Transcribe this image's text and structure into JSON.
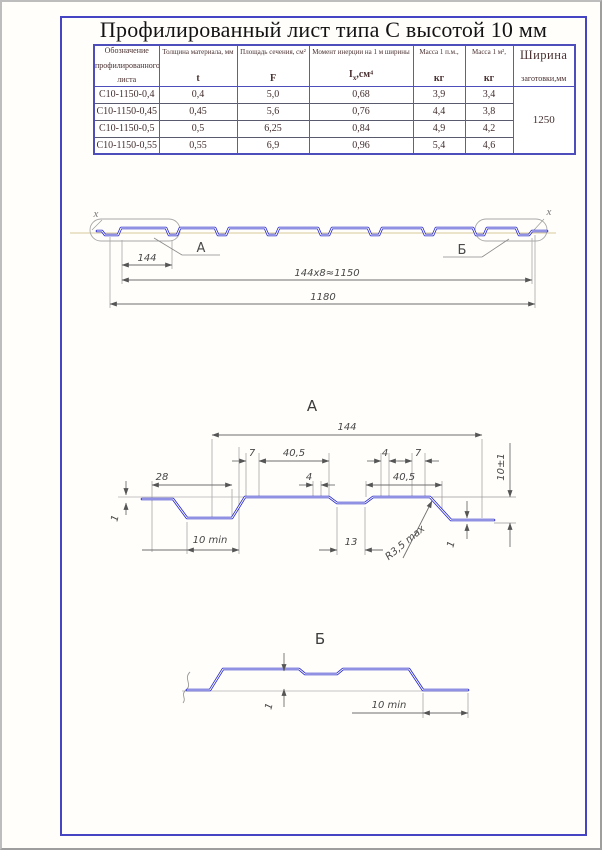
{
  "page": {
    "title": "Профилированный лист типа С высотой 10 мм"
  },
  "colors": {
    "frame_blue": "#4545c4",
    "profile_blue": "#2323c8",
    "table_border_blue": "#4d4dbb",
    "chain_line": "#ccb878",
    "text_maroon": "#432e2e"
  },
  "table": {
    "designation_header": {
      "line1": "Обозначение",
      "line2": "профилированного",
      "line3": "листа"
    },
    "columns": [
      {
        "name": "Толщина материала, мм",
        "symbol": "t"
      },
      {
        "name": "Площадь сечения, см²",
        "symbol": "F"
      },
      {
        "name": "Момент инерции на 1 м ширины",
        "symbol_base": "I",
        "symbol_sub": "x",
        "symbol_rest": ",см⁴"
      },
      {
        "name": "Масса 1 п.м.,",
        "symbol": "кг"
      },
      {
        "name": "Масса 1 м²,",
        "symbol": "кг"
      }
    ],
    "width_header": {
      "line1": "Ширина",
      "line2": "заготовки,мм"
    },
    "rows": [
      {
        "designation": "С10-1150-0,4",
        "t": "0,4",
        "F": "5,0",
        "I": "0,68",
        "mass_pm": "3,9",
        "mass_m2": "3,4"
      },
      {
        "designation": "С10-1150-0,45",
        "t": "0,45",
        "F": "5,6",
        "I": "0,76",
        "mass_pm": "4,4",
        "mass_m2": "3,8"
      },
      {
        "designation": "С10-1150-0,5",
        "t": "0,5",
        "F": "6,25",
        "I": "0,84",
        "mass_pm": "4,9",
        "mass_m2": "4,2"
      },
      {
        "designation": "С10-1150-0,55",
        "t": "0,55",
        "F": "6,9",
        "I": "0,96",
        "mass_pm": "5,4",
        "mass_m2": "4,6"
      }
    ],
    "blank_width": "1250"
  },
  "overview": {
    "axis_left": "x",
    "axis_right": "x",
    "callout_a": "А",
    "callout_b": "Б",
    "dim_pitch": "144",
    "dim_pitches_total": "144x8≈1150",
    "dim_overall": "1180"
  },
  "detail_a": {
    "title": "А",
    "dim_width": "144",
    "dim_7_left": "7",
    "dim_40_5_top": "40,5",
    "dim_4_top": "4",
    "dim_7_right": "7",
    "dim_28": "28",
    "dim_4_bottom": "4",
    "dim_40_5_bottom": "40,5",
    "dim_height": "10±1",
    "dim_thickness_left": "1",
    "dim_groove": "10 min",
    "dim_13": "13",
    "dim_radius": "R3,5 max",
    "dim_thickness_right": "1"
  },
  "detail_b": {
    "title": "Б",
    "dim_thickness": "1",
    "dim_flat": "10 min"
  }
}
